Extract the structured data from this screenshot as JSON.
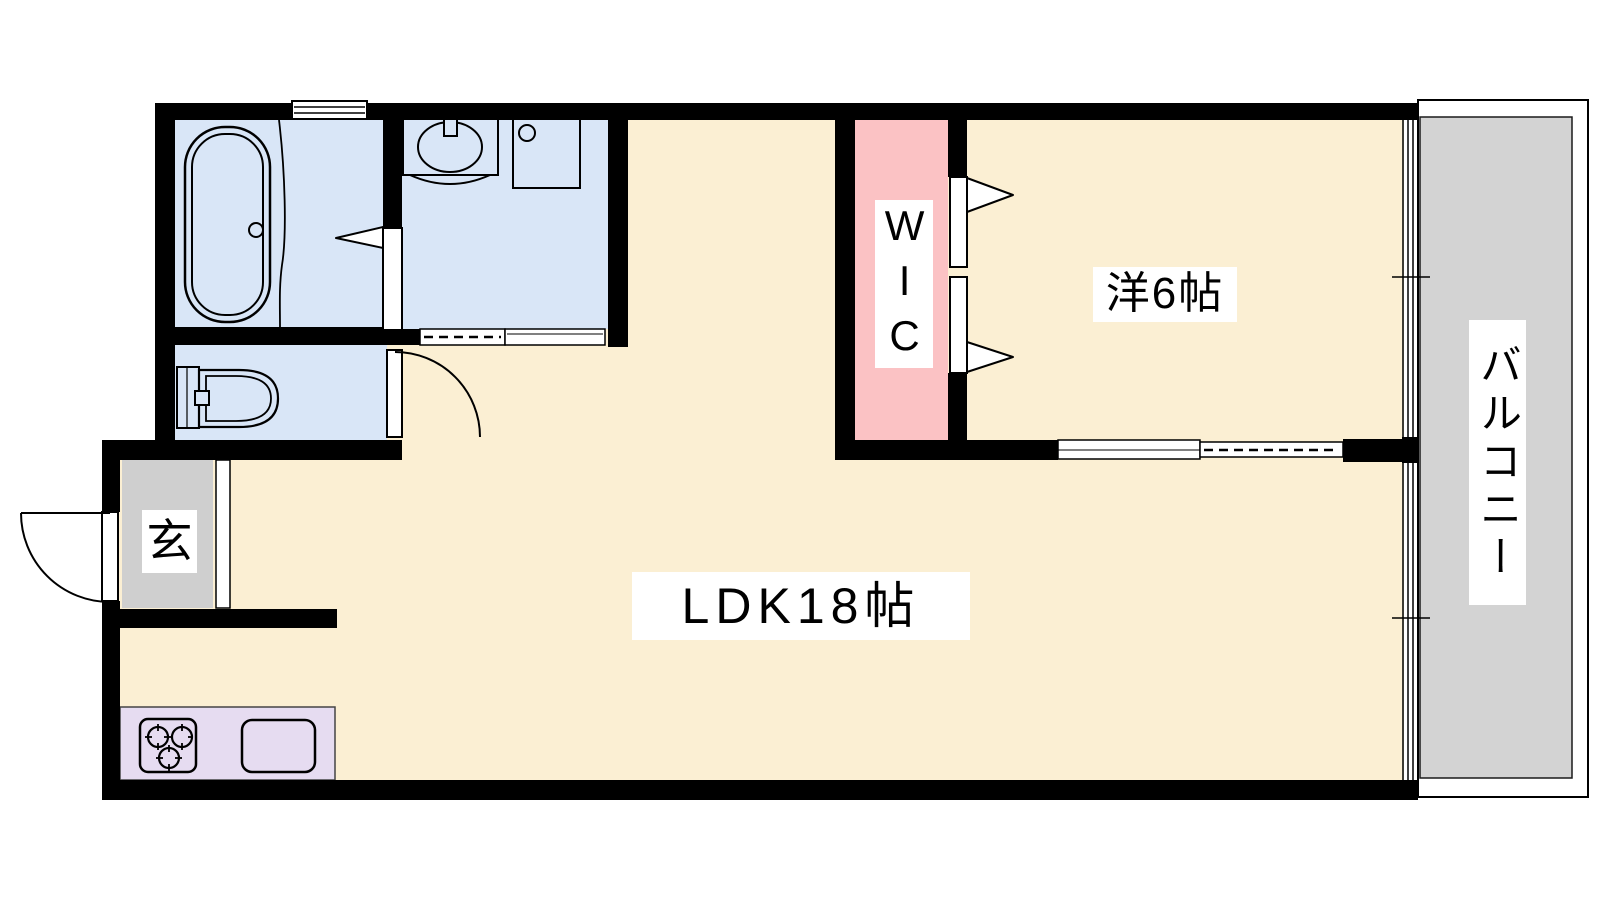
{
  "colors": {
    "cream": "#FBEFD3",
    "room-blue": "#D9E6F7",
    "wic-pink": "#FBC2C4",
    "balcony-gray": "#D3D3D3",
    "entrance-gray": "#CFCFCF",
    "kitchen-purple": "#E6DCF1",
    "wall-black": "#000000"
  },
  "rooms": {
    "ldk": {
      "label": "LDK18帖"
    },
    "bedroom": {
      "label": "洋6帖"
    },
    "wic": {
      "label": "WIC"
    },
    "balcony": {
      "label": "バルコニー"
    },
    "entrance": {
      "label": "玄"
    }
  }
}
